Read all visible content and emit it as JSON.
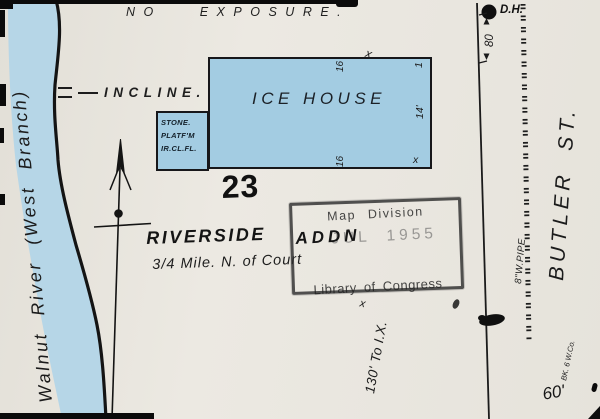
{
  "page": {
    "exposure_note": "NO EXPOSURE.",
    "sheet_number": "23"
  },
  "river": {
    "name": "Walnut River (West Branch)"
  },
  "incline": {
    "label": "INCLINE."
  },
  "ice_house": {
    "name": "ICE HOUSE",
    "wall_top": "16",
    "wall_bottom": "16",
    "stories": "1",
    "height": "14'",
    "mark_top": "x",
    "mark_corner": "x"
  },
  "platform": {
    "line1": "STONE.",
    "line2": "PLATF'M",
    "line3": "IR.CL.FL."
  },
  "addition": {
    "name": "RIVERSIDE",
    "suffix": "ADDN",
    "location_note": "3/4 Mile. N. of Court",
    "distance_note": "130' To I.X.",
    "mark": "x"
  },
  "stamp": {
    "division": "Map Division",
    "date": "JUL 1955",
    "owner": "Library of Congress"
  },
  "street": {
    "name": "BUTLER ST.",
    "hydrant_label": "D.H.",
    "width_north": "80",
    "width_south": "60'",
    "water_pipe": "8\"W.PIPE",
    "block_note": "BK. 6 W.Co."
  },
  "colors": {
    "paper": "#eae7e0",
    "water": "#b6d6e7",
    "building": "#a3cce2",
    "ink": "#1c1c1c",
    "stamp_ink": "#3c3c3c"
  }
}
